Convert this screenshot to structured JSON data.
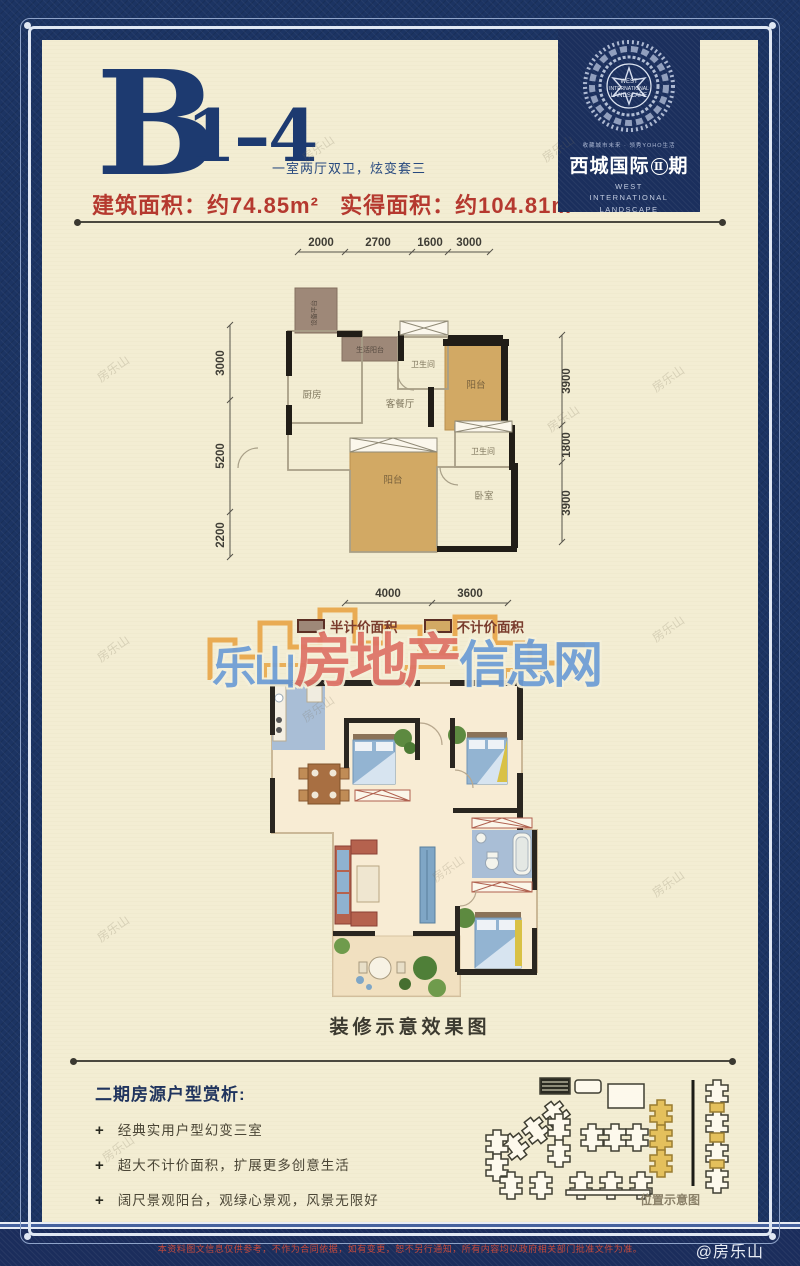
{
  "header": {
    "unit_letter": "B",
    "unit_number": "1–4",
    "subtitle": "一室两厅双卫，炫变套三",
    "area_built": "建筑面积：约74.85m²",
    "area_actual": "实得面积：约104.81m²"
  },
  "logo": {
    "emblem_line1": "WEST",
    "emblem_line2": "INTERNATIONAL",
    "emblem_line3": "LANDSCAPE",
    "tagline": "收藏城市未来 · 领秀YOHO生活",
    "name_cn": "西城国际",
    "phase_num": "Ⅱ",
    "phase_suffix": "期",
    "name_en": "WEST INTERNATIONAL LANDSCAPE"
  },
  "plan1": {
    "dims_top": [
      "2000",
      "2700",
      "1600",
      "3000"
    ],
    "dims_left": [
      "3000",
      "5200",
      "2200"
    ],
    "dims_right": [
      "3900",
      "1800",
      "3900"
    ],
    "dims_bottom": [
      "4000",
      "3600"
    ],
    "rooms": {
      "equip": "设备平台",
      "kitchen": "厨房",
      "service": "生活阳台",
      "living": "客餐厅",
      "bath1": "卫生间",
      "bath2": "卫生间",
      "bedroom": "卧室",
      "balcony_top": "阳台",
      "balcony_main": "阳台"
    }
  },
  "legend": {
    "half_price": "半计价面积",
    "no_price": "不计价面积"
  },
  "brand_watermark": {
    "seg1": "乐山",
    "seg2": "房地产",
    "seg3": "信息网"
  },
  "corner_watermark": "房乐山",
  "render_plan": {
    "caption": "装修示意效果图"
  },
  "analysis": {
    "title": "二期房源户型赏析:",
    "marker": "+",
    "bullets": [
      "经典实用户型幻变三室",
      "超大不计价面积，扩展更多创意生活",
      "阔尺景观阳台，观绿心景观，风景无限好"
    ]
  },
  "site_map": {
    "caption": "位置示意图"
  },
  "footer": {
    "disclaimer": "本资料图文信息仅供参考，不作为合同依据，如有变更，恕不另行通知，所有内容均以政府相关部门批准文件为准。",
    "credit": "@房乐山"
  }
}
